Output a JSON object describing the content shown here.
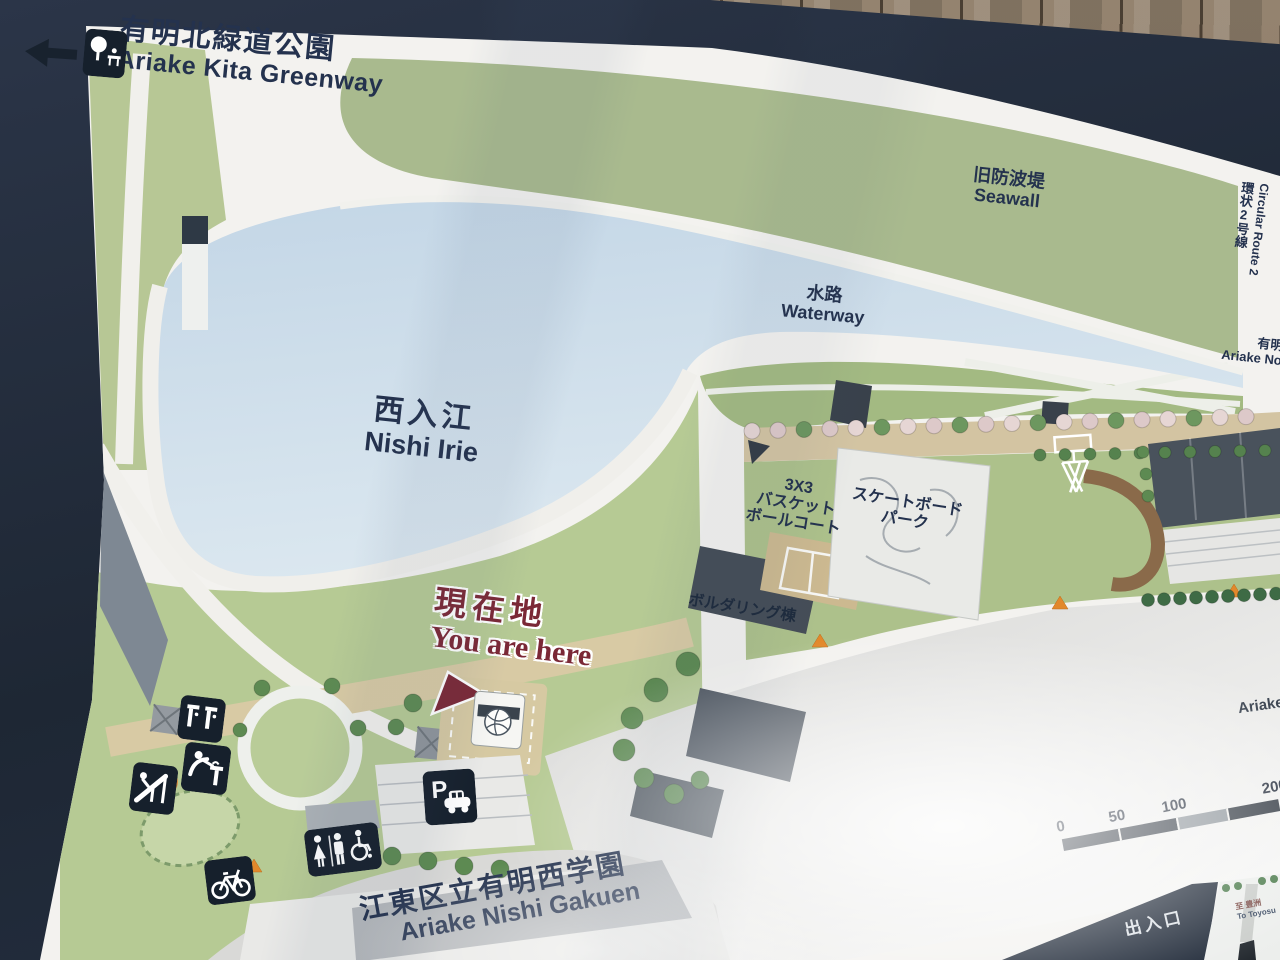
{
  "map": {
    "direction_sign": {
      "jp": "有明北緑道公園",
      "en": "Ariake Kita Greenway"
    },
    "labels": {
      "seawall": {
        "jp": "旧防波堤",
        "en": "Seawall"
      },
      "waterway": {
        "jp": "水路",
        "en": "Waterway"
      },
      "nishi_irie": {
        "jp": "西入江",
        "en": "Nishi Irie"
      },
      "you_are_here": {
        "jp": "現在地",
        "en": "You are here"
      },
      "basketball_3x3": {
        "lines": [
          "3X3",
          "バスケット",
          "ボールコート"
        ]
      },
      "skatepark": {
        "lines": [
          "スケートボード",
          "パーク"
        ]
      },
      "bouldering": {
        "jp": "ボルダリング棟"
      },
      "school": {
        "jp": "江東区立有明西学園",
        "en": "Ariake Nishi Gakuen"
      },
      "circular_route_2": {
        "jp": "環状2号線",
        "en": "Circular Route 2"
      },
      "ariake_north": {
        "jp": "有明",
        "en": "Ariake No"
      },
      "ariake_road": {
        "en": "Ariake"
      },
      "entrance_exit": {
        "jp": "出入口"
      },
      "to_toyosu": {
        "jp": "至 豊洲",
        "en": "To Toyosu"
      }
    },
    "scale_bar": {
      "ticks": [
        "0",
        "50",
        "100",
        "200"
      ]
    },
    "icons": {
      "parking_letter": "P"
    },
    "colors": {
      "sign_navy": "#222c3d",
      "ink": "#24324e",
      "water": "#c7d9e7",
      "seawall_green": "#a9ba8e",
      "park_green": "#b6ca94",
      "east_green": "#adc18b",
      "path_tan": "#d3c4a2",
      "road_gray": "#d8d8d6",
      "marker_red": "#7b2836",
      "panel_white": "#f3f2ef"
    }
  }
}
